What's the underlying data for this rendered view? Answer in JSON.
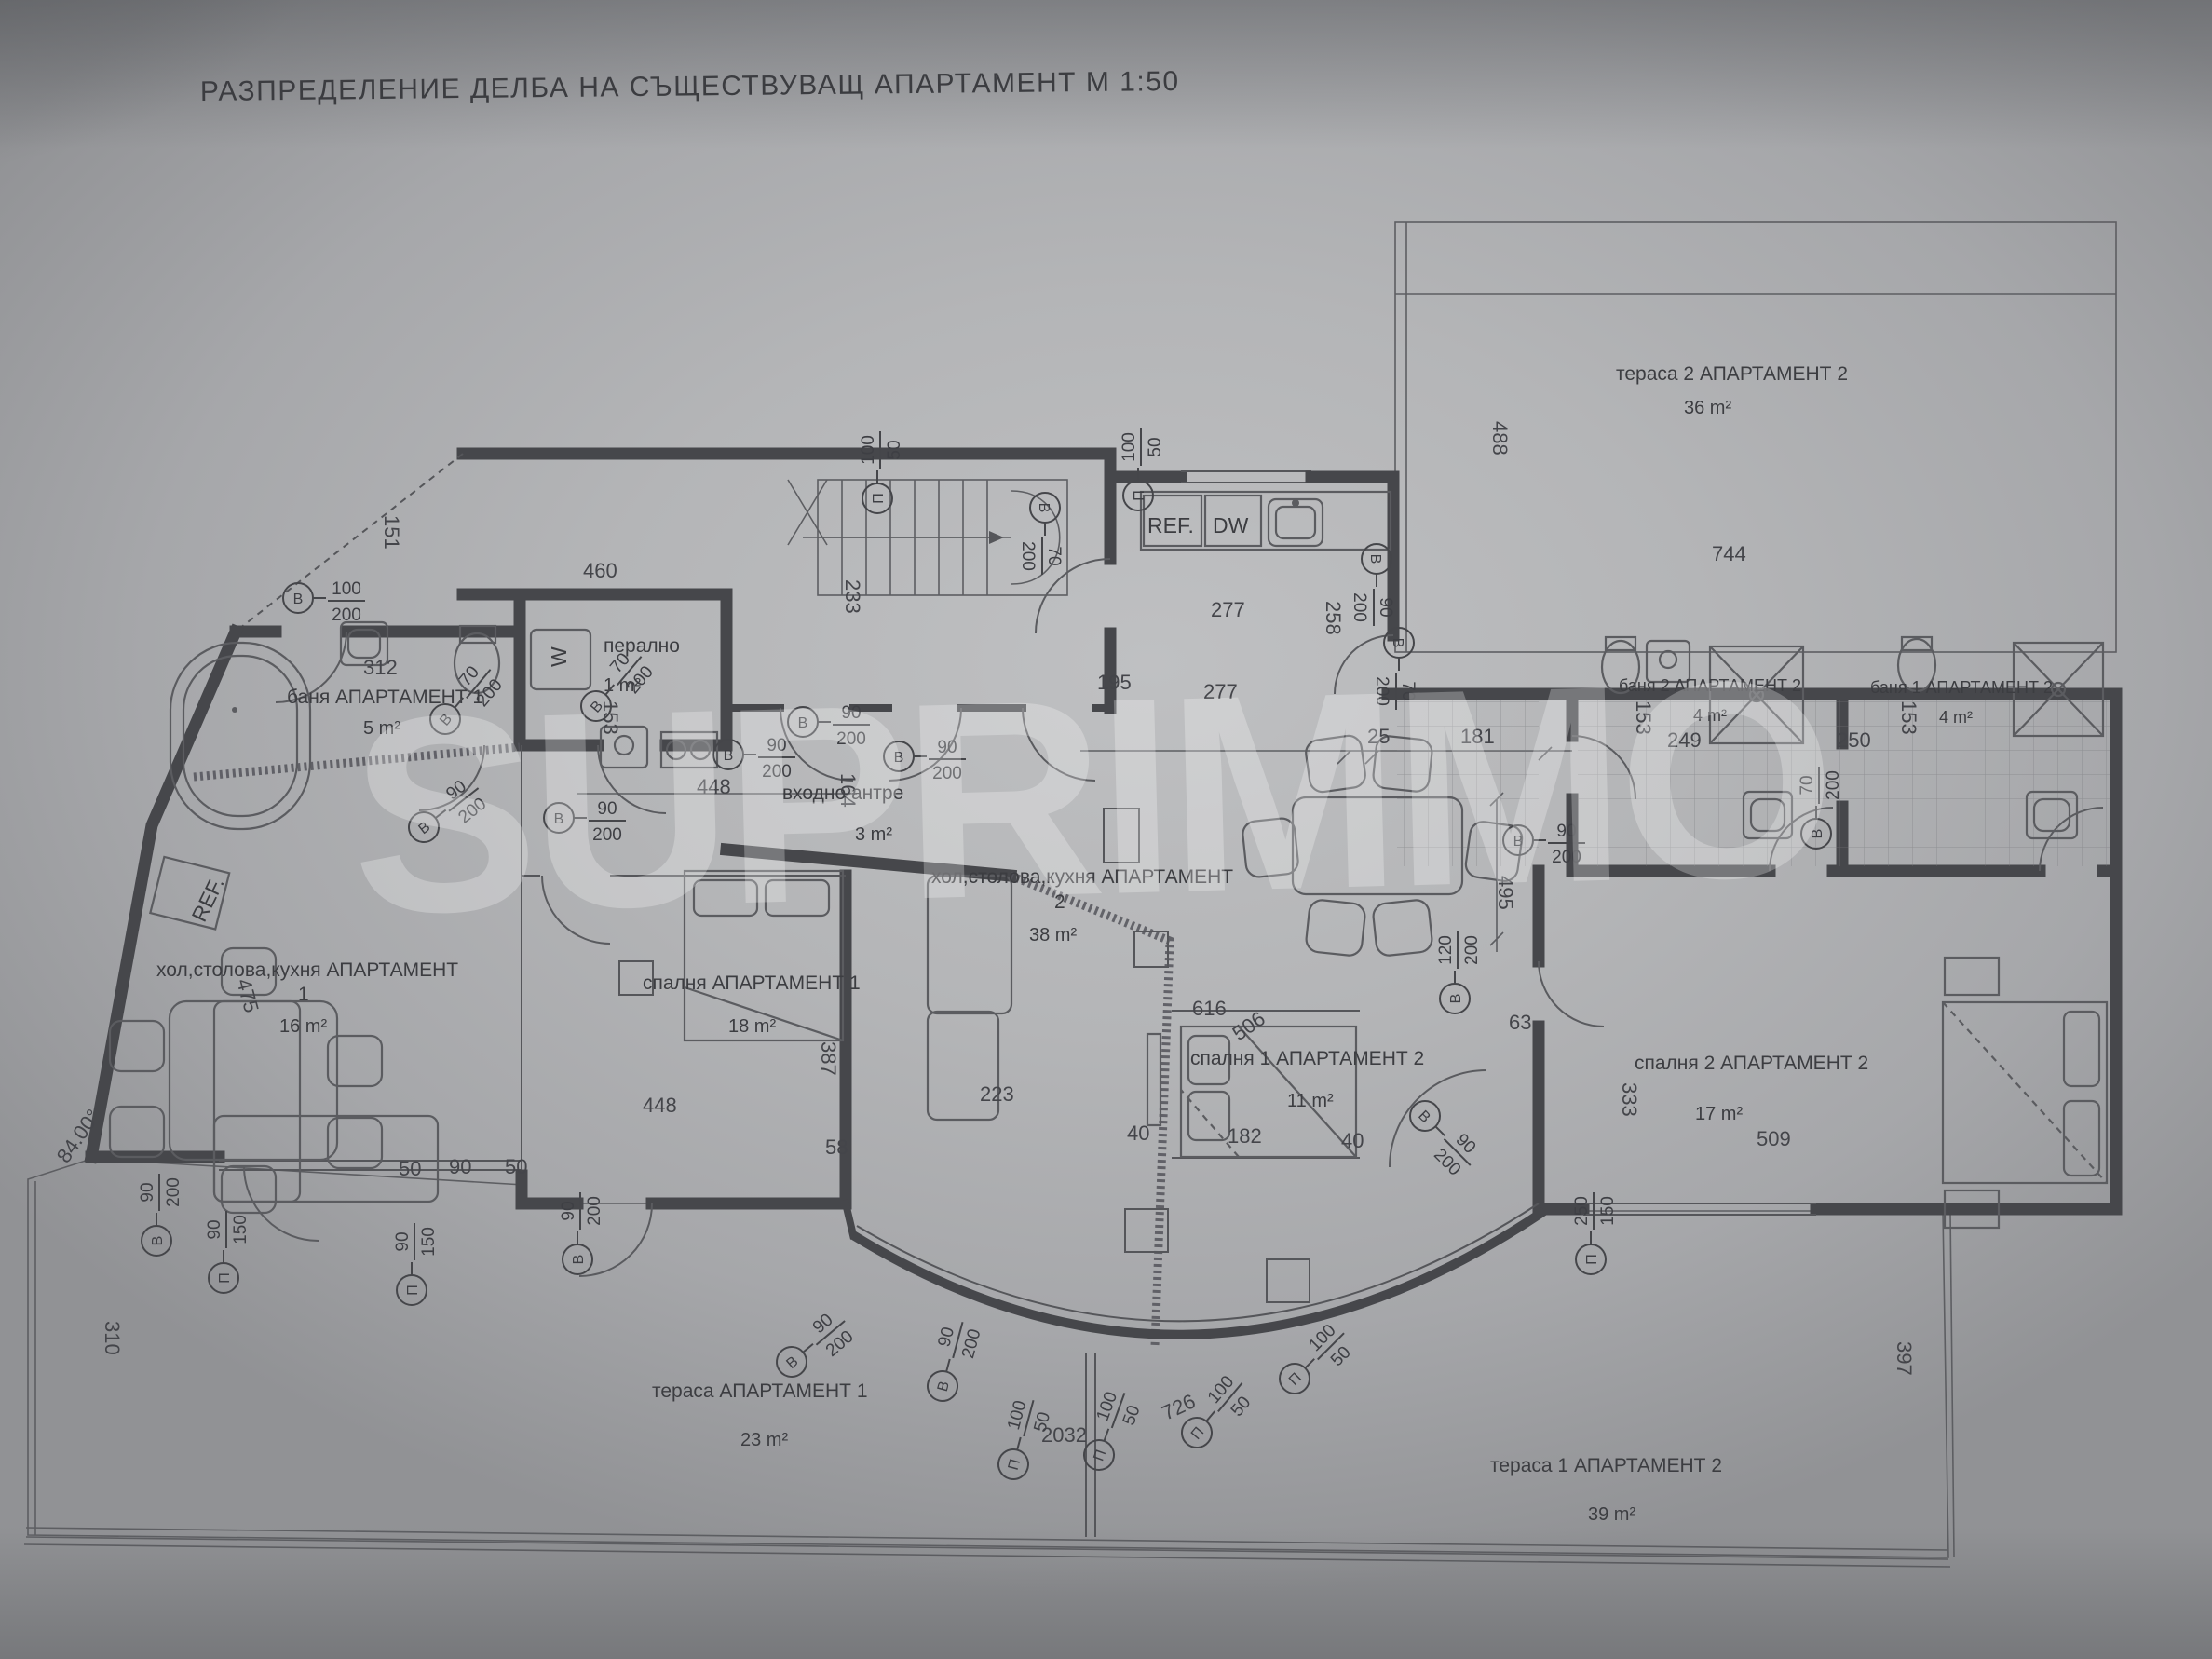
{
  "title": "РАЗПРЕДЕЛЕНИЕ ДЕЛБА НА СЪЩЕСТВУВАЩ АПАРТАМЕНТ М 1:50",
  "watermark": "SUPRIMMO",
  "rooms": [
    {
      "name": "баня АПАРТАМЕНТ 1",
      "area": "5 m²"
    },
    {
      "name": "перално",
      "area": "1 m²"
    },
    {
      "name": "входно антре",
      "area": "3 m²"
    },
    {
      "line1": "хол,столова,кухня АПАРТАМЕНТ",
      "line2": "1",
      "area": "16 m²"
    },
    {
      "name": "спалня АПАРТАМЕНТ 1",
      "area": "18 m²"
    },
    {
      "line1": "хол,столова,кухня АПАРТАМЕНТ",
      "line2": "2",
      "area": "38 m²"
    },
    {
      "name": "спалня 1 АПАРТАМЕНТ 2",
      "area": "11 m²"
    },
    {
      "name": "спалня 2 АПАРТАМЕНТ 2",
      "area": "17 m²"
    },
    {
      "name": "баня 2 АПАРТАМЕНТ 2",
      "area": "4 m²"
    },
    {
      "name": "баня 1 АПАРТАМЕНТ 2",
      "area": "4 m²"
    },
    {
      "name": "тераса 2 АПАРТАМЕНТ 2",
      "area": "36 m²"
    },
    {
      "name": "тераса АПАРТАМЕНТ 1",
      "area": "23 m²"
    },
    {
      "name": "тераса 1 АПАРТАМЕНТ 2",
      "area": "39 m²"
    }
  ],
  "fixtures": {
    "fridge1": "REF.",
    "fridge2": "REF.",
    "dishwasher": "DW",
    "washer": "W"
  },
  "dims": [
    "151",
    "233",
    "460",
    "277",
    "258",
    "277",
    "195",
    "25",
    "181",
    "488",
    "744",
    "312",
    "153",
    "448",
    "164",
    "448",
    "387",
    "223",
    "58",
    "616",
    "506",
    "63",
    "40",
    "182",
    "40",
    "495",
    "333",
    "153",
    "249",
    "250",
    "153",
    "509",
    "310",
    "2032",
    "726",
    "397",
    "475",
    "84.00°",
    "50",
    "90",
    "50"
  ],
  "openings": [
    {
      "l": "В",
      "t": "100",
      "b": "200"
    },
    {
      "l": "В",
      "t": "70",
      "b": "200"
    },
    {
      "l": "В",
      "t": "90",
      "b": "200"
    },
    {
      "l": "В",
      "t": "90",
      "b": "200"
    },
    {
      "l": "В",
      "t": "70",
      "b": "200"
    },
    {
      "l": "В",
      "t": "90",
      "b": "200"
    },
    {
      "l": "В",
      "t": "90",
      "b": "200"
    },
    {
      "l": "В",
      "t": "90",
      "b": "200"
    },
    {
      "l": "П",
      "t": "100",
      "b": "50"
    },
    {
      "l": "В",
      "t": "70",
      "b": "200"
    },
    {
      "l": "П",
      "t": "100",
      "b": "50"
    },
    {
      "l": "В",
      "t": "90",
      "b": "200"
    },
    {
      "l": "В",
      "t": "70",
      "b": "200"
    },
    {
      "l": "В",
      "t": "90",
      "b": "200"
    },
    {
      "l": "В",
      "t": "70",
      "b": "200"
    },
    {
      "l": "В",
      "t": "120",
      "b": "200"
    },
    {
      "l": "В",
      "t": "90",
      "b": "200"
    },
    {
      "l": "П",
      "t": "250",
      "b": "150"
    },
    {
      "l": "В",
      "t": "90",
      "b": "200"
    },
    {
      "l": "П",
      "t": "90",
      "b": "150"
    },
    {
      "l": "П",
      "t": "90",
      "b": "150"
    },
    {
      "l": "В",
      "t": "90",
      "b": "200"
    },
    {
      "l": "В",
      "t": "90",
      "b": "200"
    },
    {
      "l": "В",
      "t": "90",
      "b": "200"
    },
    {
      "l": "П",
      "t": "100",
      "b": "50"
    },
    {
      "l": "П",
      "t": "100",
      "b": "50"
    },
    {
      "l": "П",
      "t": "100",
      "b": "50"
    },
    {
      "l": "П",
      "t": "100",
      "b": "50"
    }
  ]
}
